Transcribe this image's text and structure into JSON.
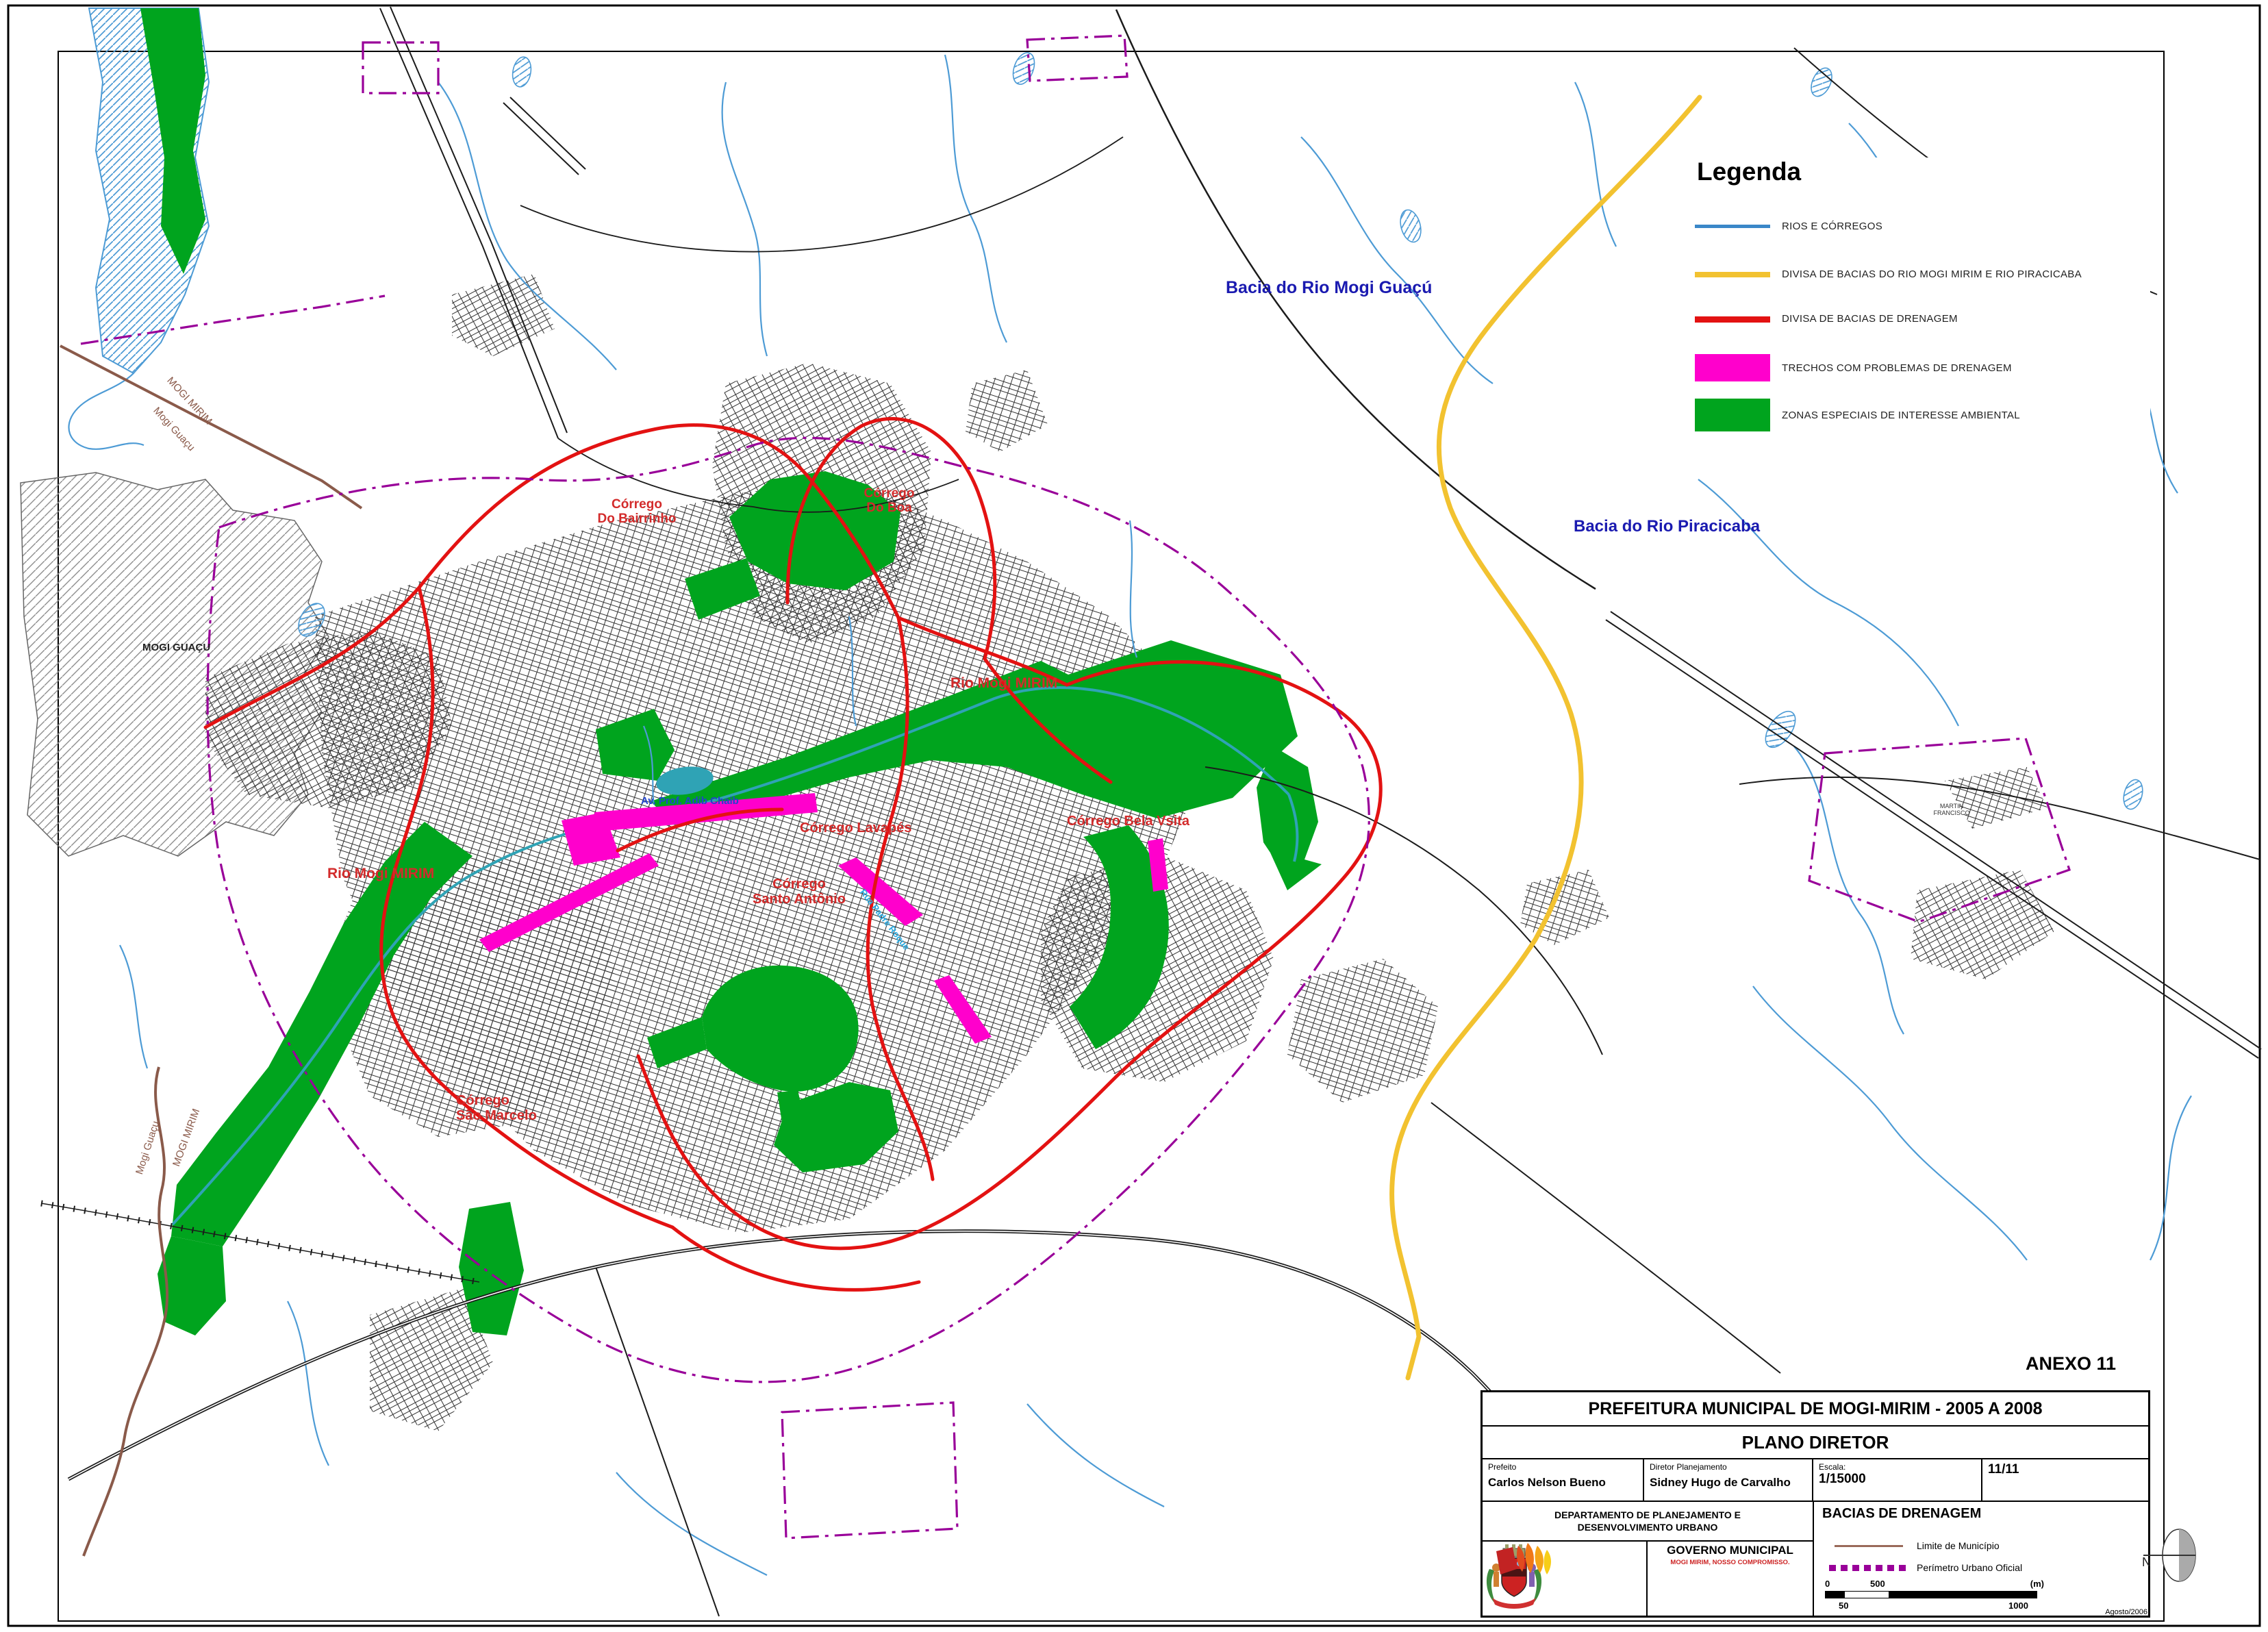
{
  "page": {
    "anexo": "ANEXO 11"
  },
  "legend": {
    "title": "Legenda",
    "items": [
      {
        "label": "RIOS E CÓRREGOS",
        "swatch": "line",
        "color": "#3A87C8"
      },
      {
        "label": "DIVISA DE BACIAS DO RIO MOGI MIRIM E RIO PIRACICABA",
        "swatch": "line",
        "color": "#F2C230"
      },
      {
        "label": "DIVISA DE BACIAS DE DRENAGEM",
        "swatch": "line",
        "color": "#E31212"
      },
      {
        "label": "TRECHOS COM PROBLEMAS DE DRENAGEM",
        "swatch": "rect",
        "color": "#FF00CC"
      },
      {
        "label": "ZONAS ESPECIAIS DE INTERESSE AMBIENTAL",
        "swatch": "rect",
        "color": "#00A41E"
      }
    ]
  },
  "map_labels": {
    "bacia_mogi_guacu": "Bacia do Rio Mogi Guaçú",
    "bacia_piracicaba": "Bacia do Rio Piracicaba",
    "corrego_bairrinho": "Córrego\nDo Bairrinho",
    "corrego_do_boa": "Córrego\nDo Boa",
    "rio_mogi_mirim_center": "Rio Mogi MIRIM",
    "rio_mogi_mirim_west": "Rio Mogi MIRIM",
    "corrego_lavapes": "Córrego Lavapés",
    "corrego_santo_antonio": "Córrego\nSanto Antônio",
    "corrego_bela_vista": "Córrego Bela Vsita",
    "corrego_sao_marcelo": "Córrego\nSão Marcelo",
    "mogi_guacu_area": "MOGI GUAÇU",
    "limit_nw_upper": "MOGI MIRIM",
    "limit_nw_lower": "Mogi Guaçu",
    "limit_sw_left": "Mogi Guaçu",
    "limit_sw_right": "MOGI MIRIM",
    "av_adib_chaib": "Av. Prof. Adib Chaib",
    "rua_padre_roque": "Rua Padre Roque",
    "martin_francisco": "MARTIN\nFRANCISCO"
  },
  "title_block": {
    "org": "PREFEITURA MUNICIPAL DE MOGI-MIRIM - 2005 A 2008",
    "plan": "PLANO DIRETOR",
    "prefeito_label": "Prefeito",
    "prefeito": "Carlos Nelson Bueno",
    "diretor_label": "Diretor Planejamento",
    "diretor": "Sidney Hugo de Carvalho",
    "escala_label": "Escala:",
    "escala": "1/15000",
    "sheet": "11/11",
    "departamento": "DEPARTAMENTO DE PLANEJAMENTO E\nDESENVOLVIMENTO URBANO",
    "map_name": "BACIAS DE DRENAGEM",
    "limite": "Limite de Município",
    "perimetro": "Perímetro Urbano Oficial",
    "north": "N",
    "governo": "GOVERNO MUNICIPAL",
    "slogan": "MOGI MIRIM, NOSSO COMPROMISSO.",
    "date": "Agosto/2006",
    "scale_bar": {
      "zero": "0",
      "mid": "500",
      "unit": "(m)",
      "sub": "50",
      "end": "1000"
    }
  },
  "colors": {
    "rivers": "#4D9BD5",
    "basin_divide_mogi_piracicaba": "#F2C230",
    "drainage_divide": "#E31212",
    "drainage_problem": "#FF00CC",
    "environmental_zone": "#00A41E",
    "municipal_limit": "#8A5A4A",
    "urban_perimeter": "#990099",
    "basin_label": "#1A1AB0",
    "stream_label": "#D32B2B"
  }
}
